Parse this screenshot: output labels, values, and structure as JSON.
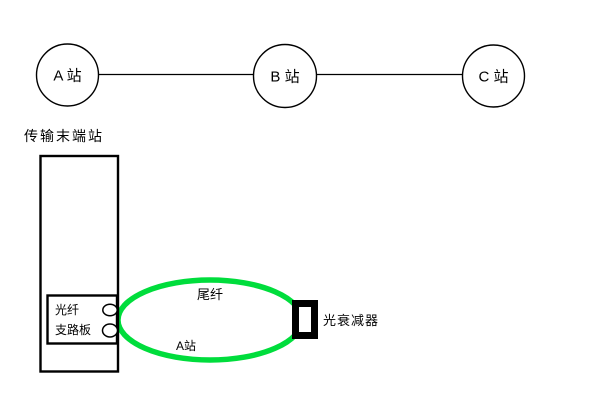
{
  "diagram": {
    "stations": [
      {
        "id": "A",
        "label": "A 站"
      },
      {
        "id": "B",
        "label": "B 站"
      },
      {
        "id": "C",
        "label": "C 站"
      }
    ],
    "terminal_station_label": "传输末端站",
    "equipment": {
      "fiber_label": "光纤",
      "tributary_board_label": "支路板"
    },
    "fiber_loop": {
      "pigtail_label": "尾纤",
      "station_label": "A站"
    },
    "attenuator_label": "光衰减器",
    "colors": {
      "fiber_green": "#00DD3C",
      "ink": "#000000",
      "background": "#FFFFFF"
    }
  }
}
